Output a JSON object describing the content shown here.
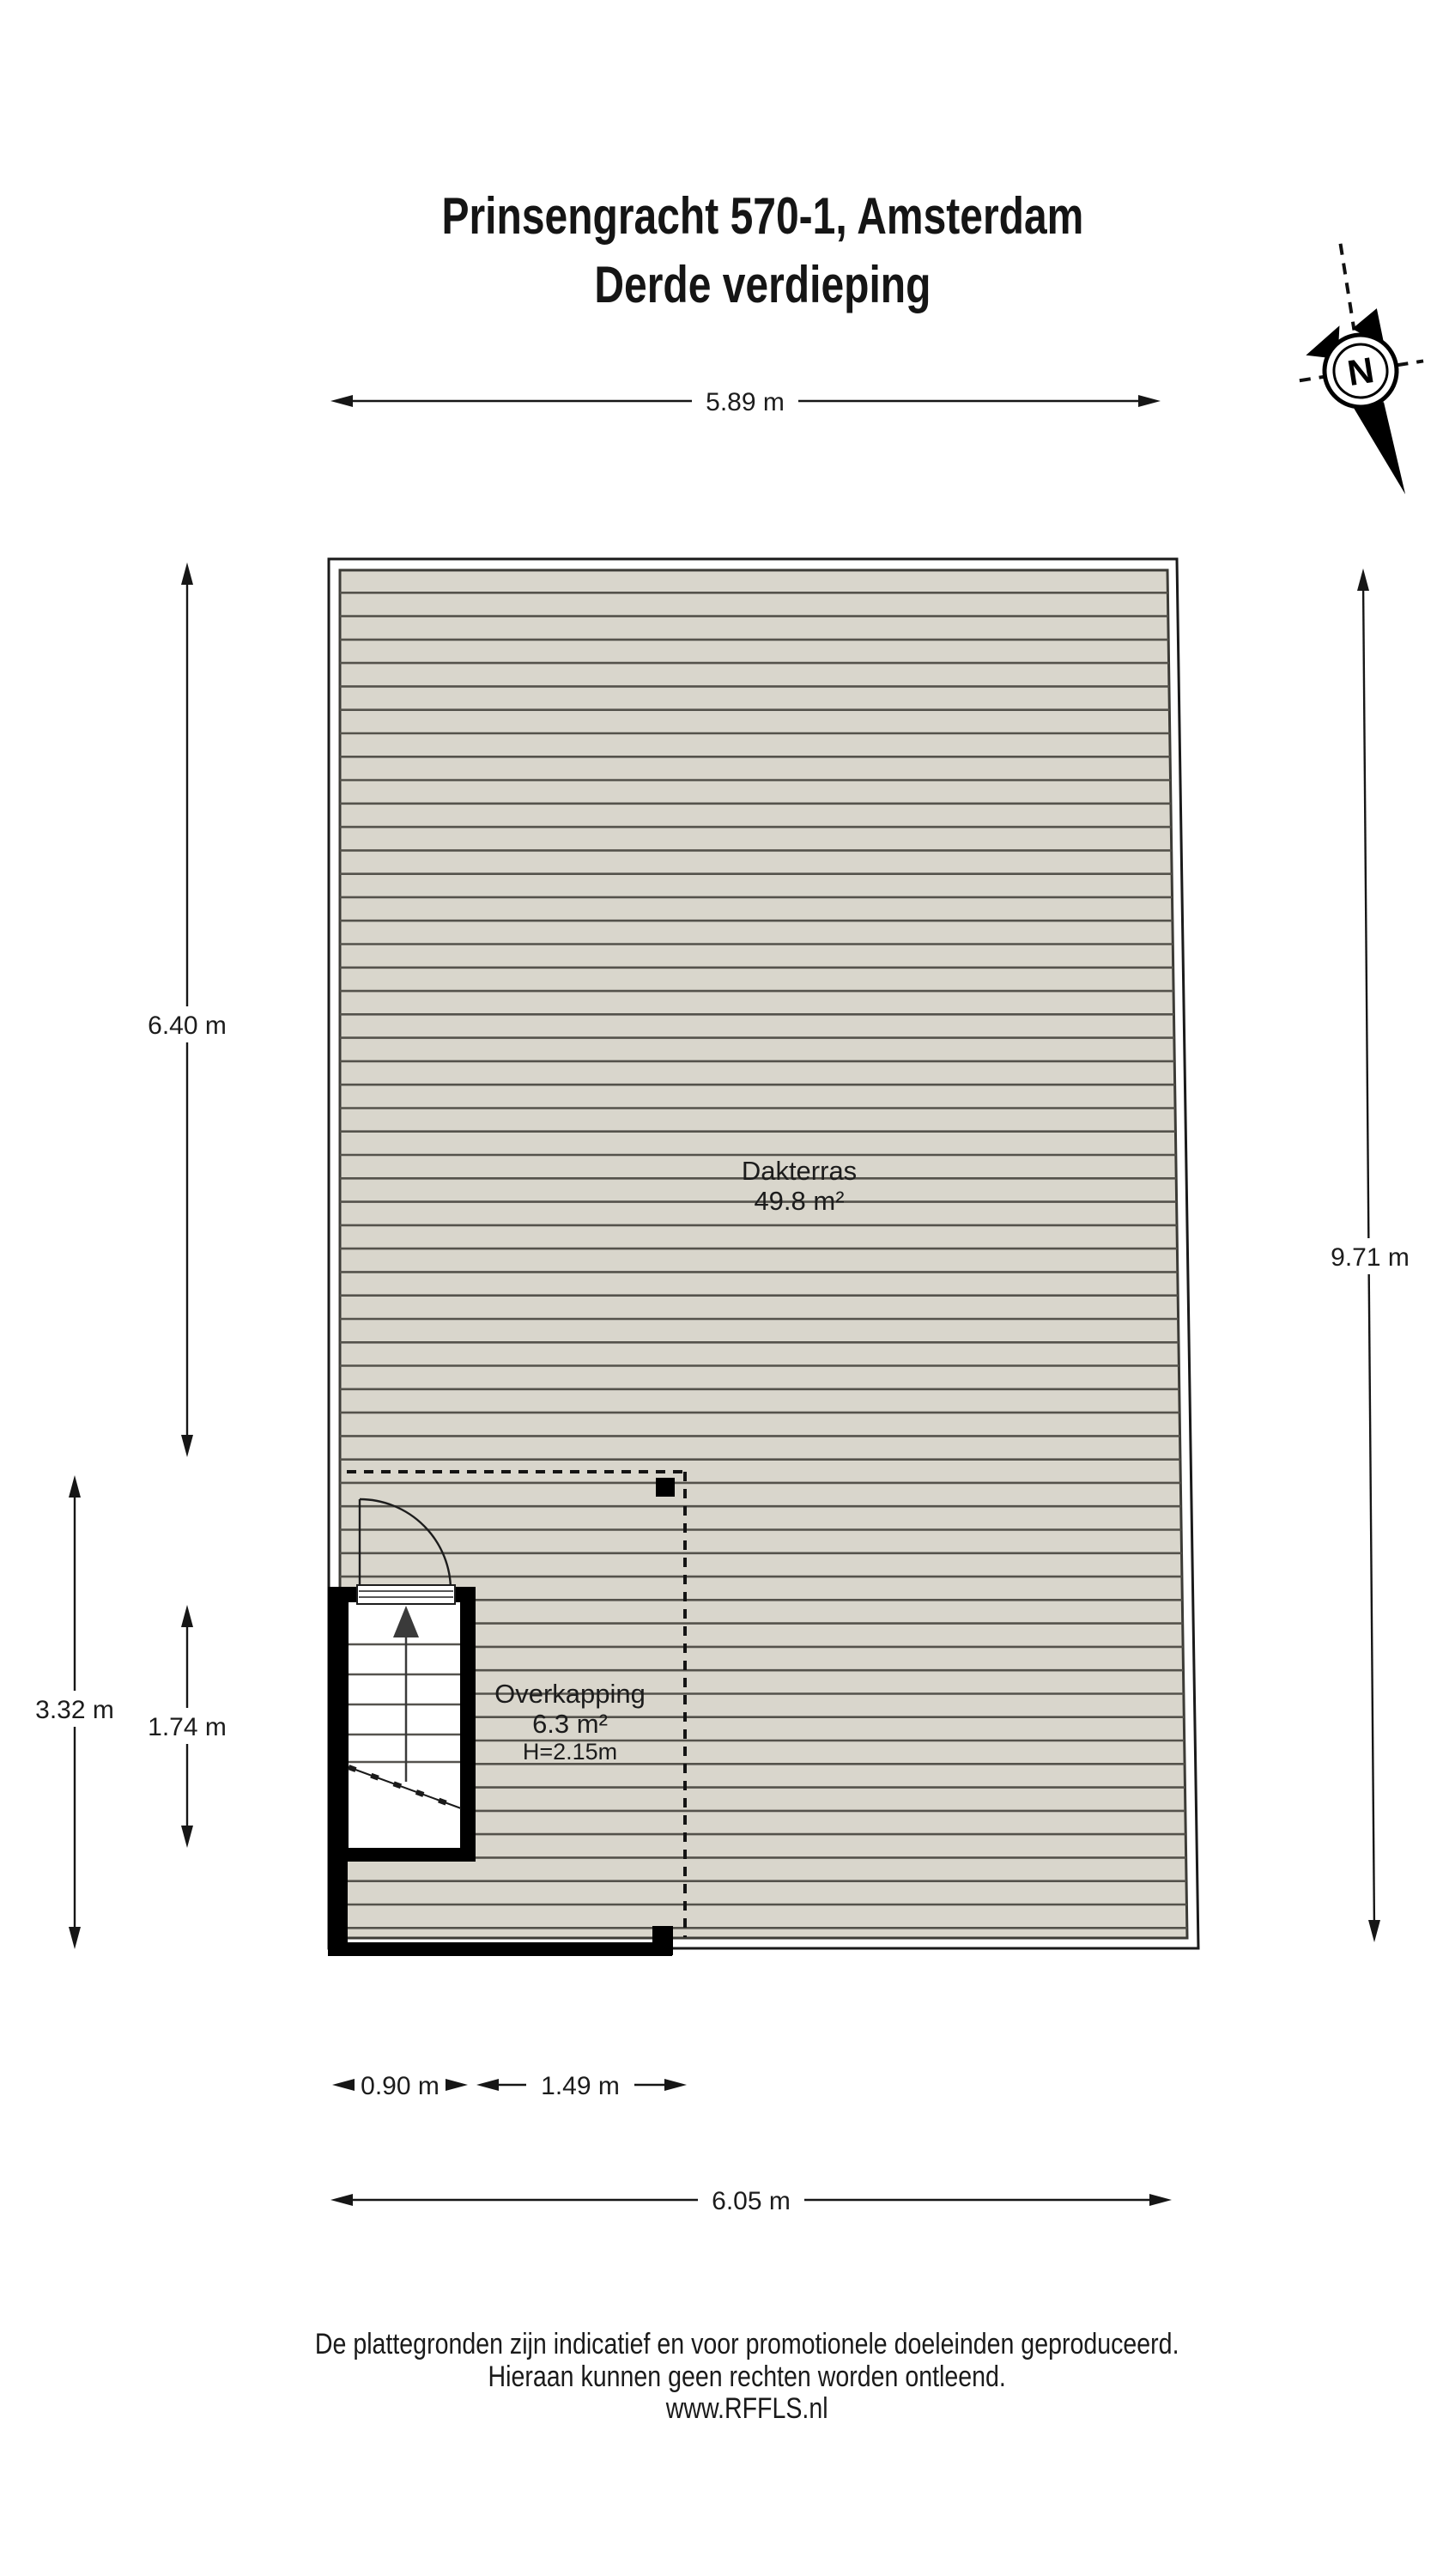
{
  "title": {
    "line1": "Prinsengracht 570-1, Amsterdam",
    "line2": "Derde verdieping"
  },
  "compass": {
    "label": "N"
  },
  "plan": {
    "rooms": {
      "dakterras": {
        "name": "Dakterras",
        "area": "49.8 m²"
      },
      "overkapping": {
        "name": "Overkapping",
        "area": "6.3 m²",
        "height": "H=2.15m"
      }
    },
    "colors": {
      "deck_fill": "#d9d6cc",
      "deck_stripe": "#54524b",
      "wall": "#000000",
      "outline": "#1a1a1a"
    }
  },
  "dimensions": {
    "top_width": "5.89 m",
    "left_upper": "6.40 m",
    "right_height": "9.71 m",
    "left_lower": "3.32 m",
    "stair_height": "1.74 m",
    "stair_width": "0.90 m",
    "overkapping_width": "1.49 m",
    "bottom_width": "6.05 m"
  },
  "footer": {
    "line1": "De plattegronden zijn indicatief en voor promotionele doeleinden geproduceerd.",
    "line2": "Hieraan kunnen geen rechten worden ontleend.",
    "line3": "www.RFFLS.nl"
  }
}
